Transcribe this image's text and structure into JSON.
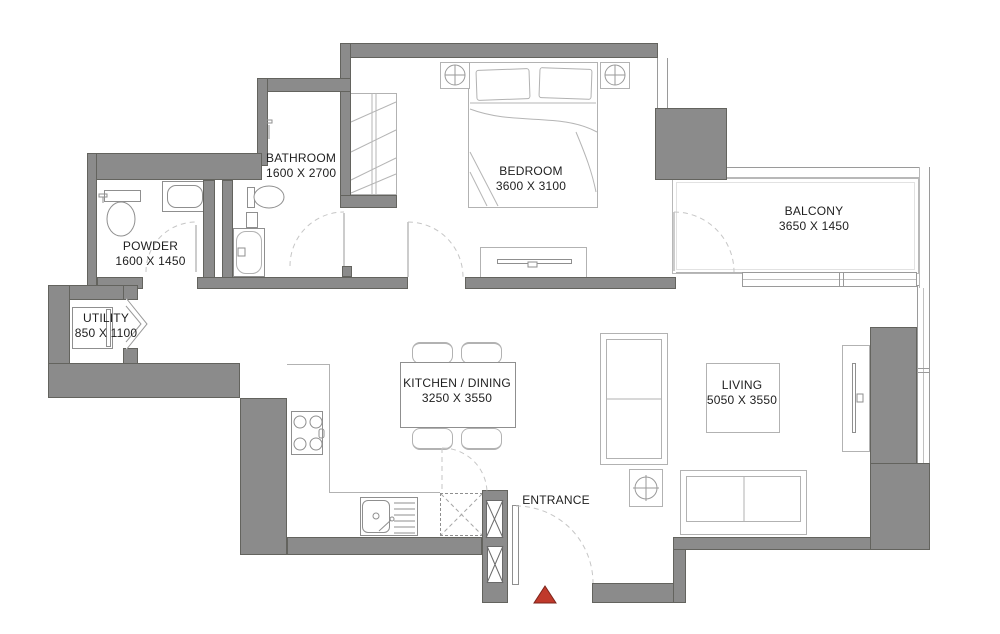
{
  "colors": {
    "wall": "#8b8b8b",
    "walledge": "#63635e",
    "furn": "#b2b2b2",
    "furndark": "#8f8f8f",
    "arc": "#c6c6c6",
    "text": "#1e1e1e",
    "marker": "#c0392b",
    "markeredge": "#7c241b"
  },
  "rooms": {
    "bathroom": {
      "name": "BATHROOM",
      "dims": "1600 X 2700"
    },
    "bedroom": {
      "name": "BEDROOM",
      "dims": "3600 X 3100"
    },
    "balcony": {
      "name": "BALCONY",
      "dims": "3650 X 1450"
    },
    "powder": {
      "name": "POWDER",
      "dims": "1600 X 1450"
    },
    "utility": {
      "name": "UTILITY",
      "dims": "850 X 1100"
    },
    "kitchen": {
      "name": "KITCHEN / DINING",
      "dims": "3250 X 3550"
    },
    "living": {
      "name": "LIVING",
      "dims": "5050 X 3550"
    }
  },
  "entrance": {
    "label": "ENTRANCE"
  }
}
